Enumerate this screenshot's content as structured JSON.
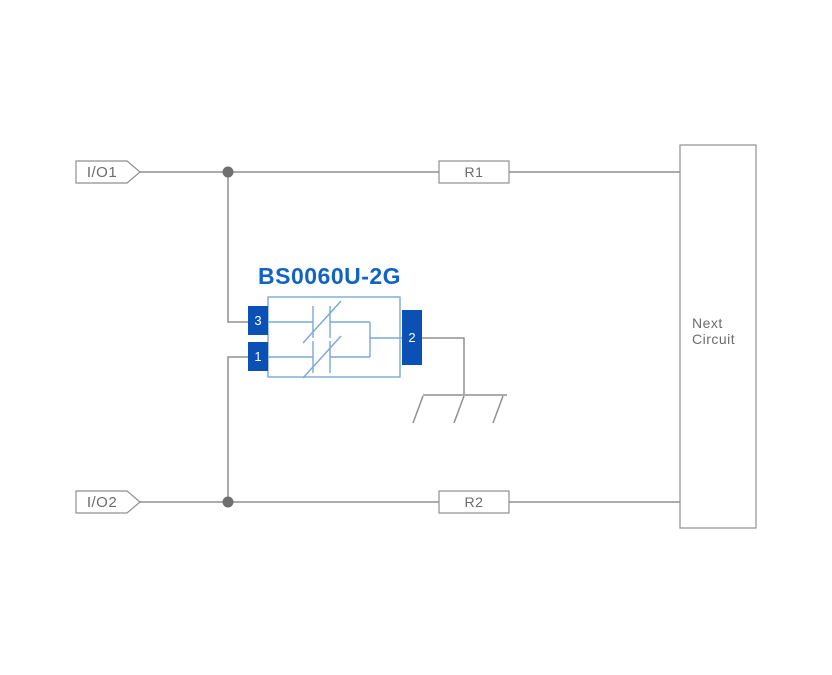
{
  "schematic": {
    "component_title": "BS0060U-2G",
    "io1_label": "I/O1",
    "io2_label": "I/O2",
    "r1_label": "R1",
    "r2_label": "R2",
    "pin_top_left": "3",
    "pin_bottom_left": "1",
    "pin_right": "2",
    "next_circuit_line1": "Next",
    "next_circuit_line2": "Circuit",
    "colors": {
      "background": "#ffffff",
      "wire": "#8f8f8f",
      "junction_dot": "#6f6f6f",
      "label_text": "#6b6b6b",
      "component_outline": "#7aa7d9",
      "pin_fill": "#0b51b5",
      "pin_text": "#ffffff",
      "title_text": "#1263c6"
    }
  }
}
